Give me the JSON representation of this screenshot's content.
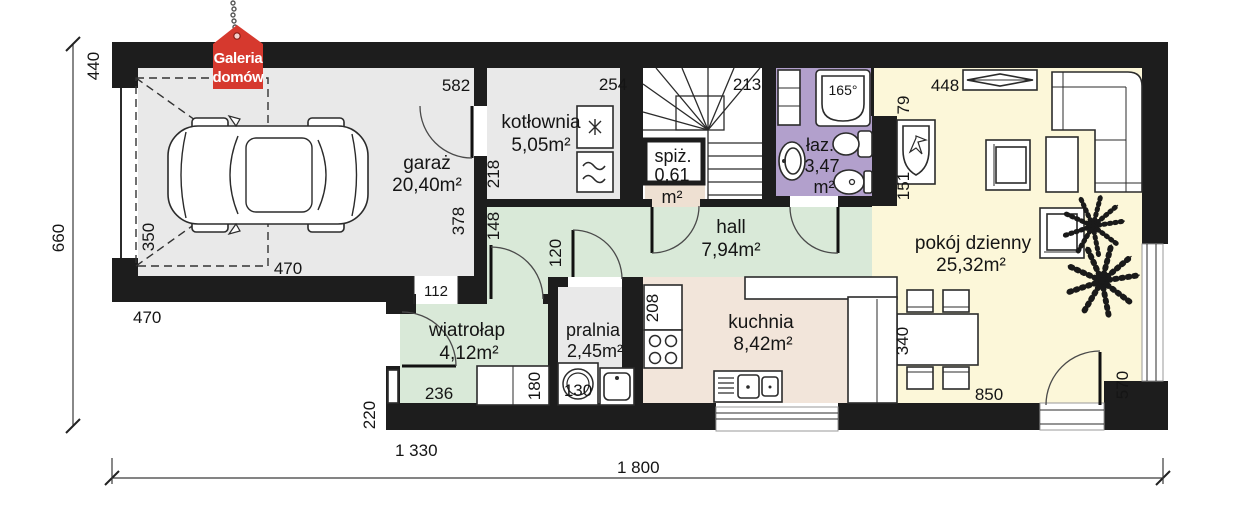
{
  "title": "house ground floor plan",
  "logo": {
    "line1": "Galeria",
    "line2": "domów",
    "color": "#d6392e"
  },
  "rooms": {
    "garage": {
      "name": "garaż",
      "area": "20,40m²"
    },
    "boiler_room": {
      "name": "kotłownia",
      "area": "5,05m²"
    },
    "pantry": {
      "name": "spiż.",
      "area": "0,61",
      "unit": "m²"
    },
    "hall": {
      "name": "hall",
      "area": "7,94m²"
    },
    "bathroom": {
      "name": "łaz.",
      "area": "3,47",
      "unit": "m²",
      "tub_angle": "165°"
    },
    "living_room": {
      "name": "pokój dzienny",
      "area": "25,32m²"
    },
    "vestibule": {
      "name": "wiatrołap",
      "area": "4,12m²"
    },
    "laundry": {
      "name": "pralnia",
      "area": "2,45m²"
    },
    "kitchen": {
      "name": "kuchnia",
      "area": "8,42m²"
    }
  },
  "dims": {
    "d440": "440",
    "d660": "660",
    "d470_left": "470",
    "d1330": "1 330",
    "d1800": "1 800",
    "d582": "582",
    "d254": "254",
    "d213": "213",
    "d448": "448",
    "d218": "218",
    "d378": "378",
    "d148": "148",
    "d120": "120",
    "d112": "112",
    "d350": "350",
    "d470_garage": "470",
    "d236": "236",
    "d180": "180",
    "d130": "130",
    "d208": "208",
    "d340": "340",
    "d850": "850",
    "d570": "570",
    "d220": "220",
    "d79": "79",
    "d151": "151"
  },
  "colors": {
    "wall": "#1d1d1d",
    "garage_floor": "#e9e9e9",
    "hall_floor": "#d9e9d8",
    "bath_floor": "#b2a0cc",
    "living_floor": "#fcf7d9",
    "kitchen_floor": "#f2e5da",
    "pantry_niche": "#eee0d2",
    "logo_red": "#d6392e"
  }
}
